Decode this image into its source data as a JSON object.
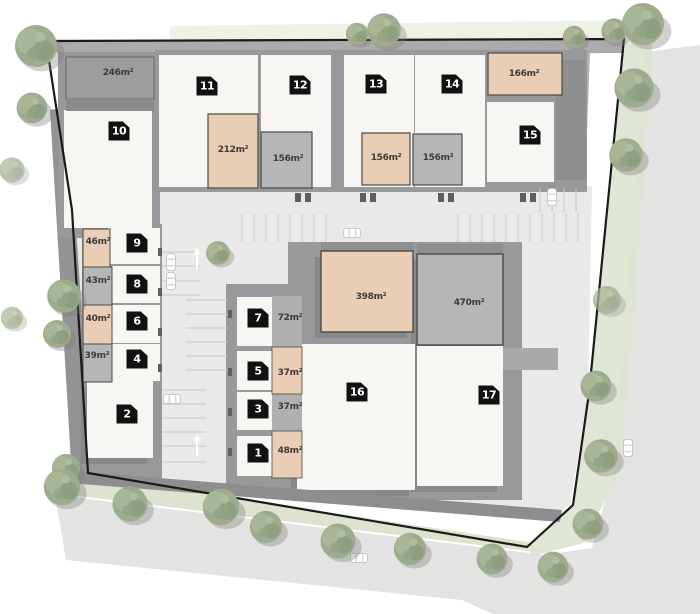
{
  "plan_name": "site-plan",
  "units": [
    {
      "number": "1",
      "area": "48m²"
    },
    {
      "number": "2",
      "area": ""
    },
    {
      "number": "3",
      "area": "37m²"
    },
    {
      "number": "4",
      "area": "39m²"
    },
    {
      "number": "5",
      "area": "37m²"
    },
    {
      "number": "6",
      "area": "40m²"
    },
    {
      "number": "7",
      "area": "72m²"
    },
    {
      "number": "8",
      "area": "43m²"
    },
    {
      "number": "9",
      "area": "46m²"
    },
    {
      "number": "10",
      "area": "246m²"
    },
    {
      "number": "11",
      "area": "212m²"
    },
    {
      "number": "12",
      "area": "156m²"
    },
    {
      "number": "13",
      "area": "156m²"
    },
    {
      "number": "14",
      "area": "156m²"
    },
    {
      "number": "15",
      "area": "166m²"
    },
    {
      "number": "16",
      "area": "398m²"
    },
    {
      "number": "17",
      "area": "470m²"
    }
  ],
  "icons": {
    "tree": "tree-icon",
    "car": "car-icon",
    "direction_arrow": "direction-arrow-icon"
  },
  "colors": {
    "boundary_line": "#1a1a1a",
    "building_white": "#f8f6f2",
    "building_peach": "#e9cdb4",
    "building_gray": "#b5b6b6",
    "roof_dark_gray": "#98999b",
    "pavement": "#e9e9e7",
    "street": "#e3e3e1",
    "greenery": "#dde3d0",
    "tree_green": "#9dab8e",
    "badge_background": "#111111",
    "badge_text": "#ffffff",
    "area_label_text": "#3b3b3b"
  }
}
